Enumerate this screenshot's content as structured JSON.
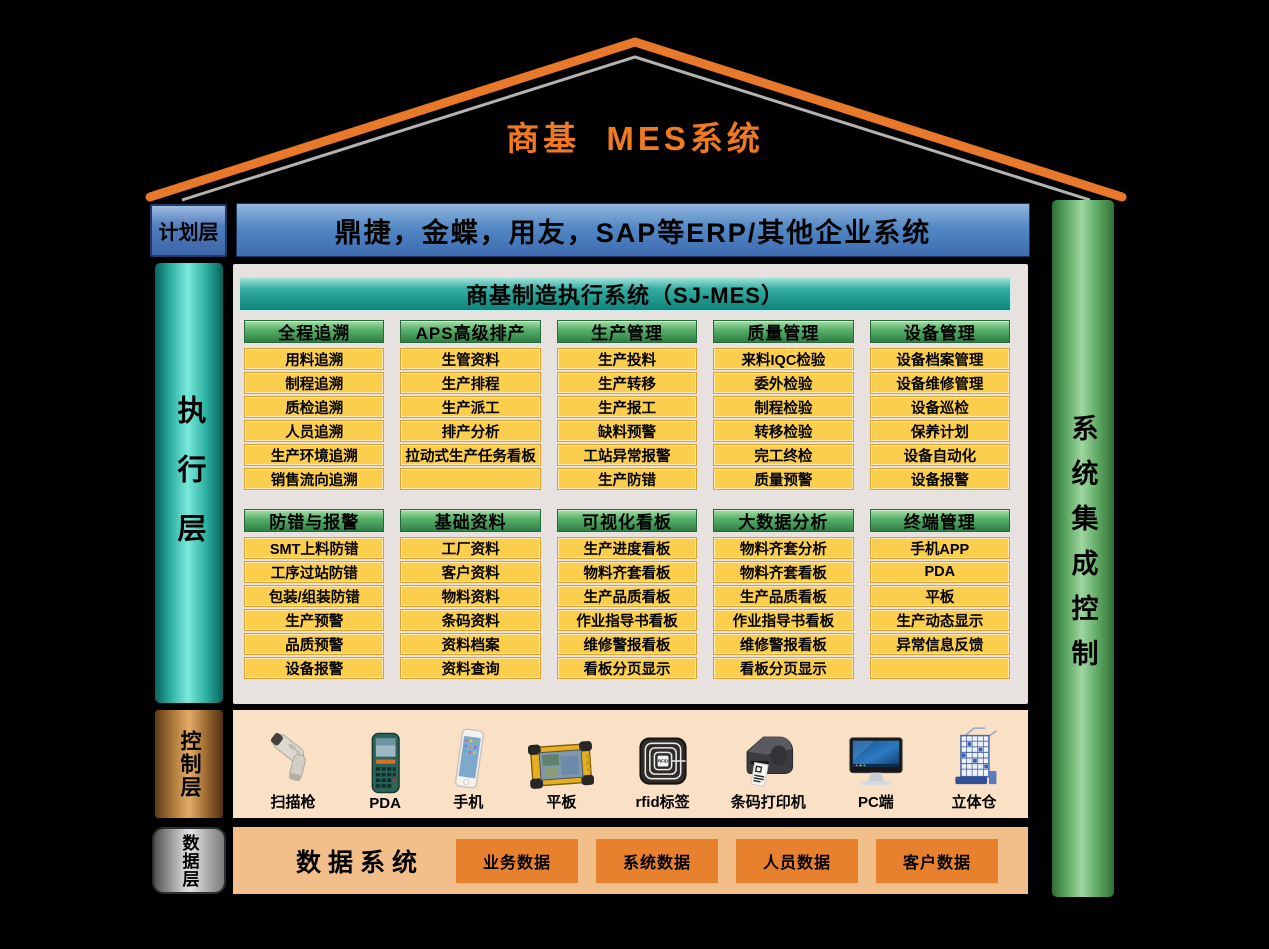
{
  "title": "商基  MES系统",
  "planning_layer": {
    "label": "计划层",
    "erp_bar": "鼎捷，金蝶，用友，SAP等ERP/其他企业系统"
  },
  "execution_layer": {
    "label": "执行层",
    "banner": "商基制造执行系统（SJ-MES）",
    "rows": [
      [
        {
          "header": "全程追溯",
          "items": [
            "用料追溯",
            "制程追溯",
            "质检追溯",
            "人员追溯",
            "生产环境追溯",
            "销售流向追溯"
          ]
        },
        {
          "header": "APS高级排产",
          "items": [
            "生管资料",
            "生产排程",
            "生产派工",
            "排产分析",
            "拉动式生产任务看板",
            ""
          ]
        },
        {
          "header": "生产管理",
          "items": [
            "生产投料",
            "生产转移",
            "生产报工",
            "缺料预警",
            "工站异常报警",
            "生产防错"
          ]
        },
        {
          "header": "质量管理",
          "items": [
            "来料IQC检验",
            "委外检验",
            "制程检验",
            "转移检验",
            "完工终检",
            "质量预警"
          ]
        },
        {
          "header": "设备管理",
          "items": [
            "设备档案管理",
            "设备维修管理",
            "设备巡检",
            "保养计划",
            "设备自动化",
            "设备报警"
          ]
        }
      ],
      [
        {
          "header": "防错与报警",
          "items": [
            "SMT上料防错",
            "工序过站防错",
            "包装/组装防错",
            "生产预警",
            "品质预警",
            "设备报警"
          ]
        },
        {
          "header": "基础资料",
          "items": [
            "工厂资料",
            "客户资料",
            "物料资料",
            "条码资料",
            "资料档案",
            "资料查询"
          ]
        },
        {
          "header": "可视化看板",
          "items": [
            "生产进度看板",
            "物料齐套看板",
            "生产品质看板",
            "作业指导书看板",
            "维修警报看板",
            "看板分页显示"
          ]
        },
        {
          "header": "大数据分析",
          "items": [
            "物料齐套分析",
            "物料齐套看板",
            "生产品质看板",
            "作业指导书看板",
            "维修警报看板",
            "看板分页显示"
          ]
        },
        {
          "header": "终端管理",
          "items": [
            "手机APP",
            "PDA",
            "平板",
            "生产动态显示",
            "异常信息反馈",
            ""
          ]
        }
      ]
    ]
  },
  "integration_pillar": {
    "label": "系统集成控制"
  },
  "control_layer": {
    "label": "控制层",
    "devices": [
      {
        "label": "扫描枪",
        "icon": "barcode-scanner"
      },
      {
        "label": "PDA",
        "icon": "pda"
      },
      {
        "label": "手机",
        "icon": "smartphone"
      },
      {
        "label": "平板",
        "icon": "rugged-tablet"
      },
      {
        "label": "rfid标签",
        "icon": "rfid-tag"
      },
      {
        "label": "条码打印机",
        "icon": "label-printer"
      },
      {
        "label": "PC端",
        "icon": "desktop-pc"
      },
      {
        "label": "立体仓",
        "icon": "automated-warehouse"
      }
    ]
  },
  "data_layer": {
    "label": "数据层",
    "title": "数据系统",
    "boxes": [
      "业务数据",
      "系统数据",
      "人员数据",
      "客户数据"
    ]
  },
  "colors": {
    "background": "#000000",
    "roof_orange": "#E8782A",
    "title_orange": "#F07A22",
    "planning_blue": "#4A7EBB",
    "banner_teal": "#1B9E94",
    "module_header_green": "#57B169",
    "module_cell_yellow": "#FBCE4D",
    "cell_border_orange": "#DFA02F",
    "panel_gray": "#E7E1E0",
    "exec_pillar_teal": "#2FB3A6",
    "integration_pillar_green": "#5FA964",
    "control_pillar_copper": "#B5803F",
    "data_pillar_gray": "#9A9A9A",
    "control_bg_peach": "#FAE1C5",
    "data_bg_orange": "#F2BE8A",
    "data_box_orange": "#E8812E"
  }
}
